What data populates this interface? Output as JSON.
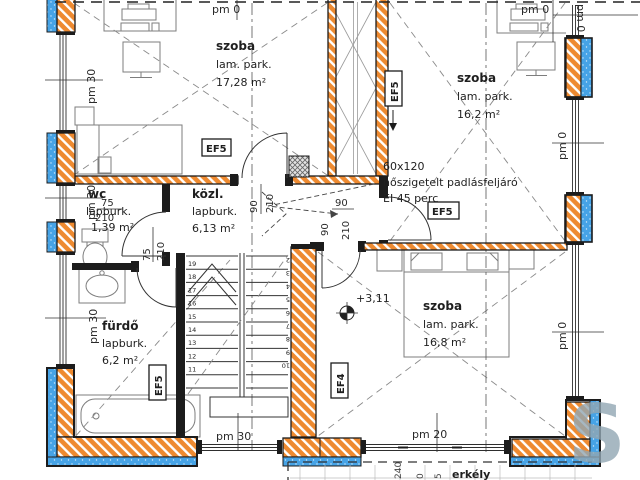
{
  "rooms": [
    {
      "name": "szoba",
      "floor": "lam. park.",
      "area": "17,28 m²"
    },
    {
      "name": "szoba",
      "floor": "lam. park.",
      "area": "16,2 m²"
    },
    {
      "name": "wc",
      "floor": "lapburk.",
      "area": "1,39 m²"
    },
    {
      "name": "közl.",
      "floor": "lapburk.",
      "area": "6,13 m²"
    },
    {
      "name": "fürdő",
      "floor": "lapburk.",
      "area": "6,2 m²"
    },
    {
      "name": "szoba",
      "floor": "lam. park.",
      "area": "16,8 m²"
    }
  ],
  "attic": {
    "size": "60x120",
    "note": "hőszigetelt padlásfeljáró",
    "fire_rating": "EI 45 perc"
  },
  "levels": {
    "floor_height": "+3,11"
  },
  "dims": {
    "pm0": "pm 0",
    "pm20": "pm 20",
    "pm30": "pm 30",
    "door_width_90": "90",
    "door_width_75": "75",
    "door_height_210": "210"
  },
  "element_tags": {
    "ef5": "EF5",
    "ef4": "EF4"
  },
  "stairs": {
    "up_flight": [
      "19",
      "18",
      "17",
      "16",
      "15",
      "14",
      "13",
      "12",
      "11"
    ],
    "down_flight": [
      "2",
      "3",
      "4",
      "5",
      "6",
      "7",
      "8",
      "9",
      "10"
    ]
  },
  "balcony": {
    "name": "erkély",
    "dims": [
      "240",
      "0",
      "5"
    ]
  },
  "watermark": "S",
  "colors": {
    "masonry": "#ee8a30",
    "insulation": "#46a3e6",
    "line": "#1c1c1c"
  }
}
